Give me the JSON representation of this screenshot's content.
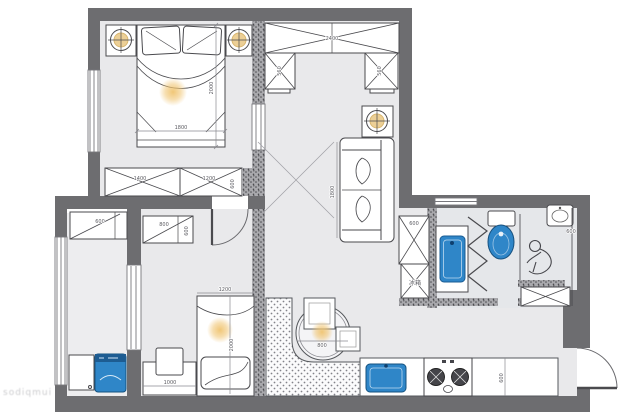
{
  "plan": {
    "wall_color": "#6d6d70",
    "floor_color": "#e9e9eb",
    "fixture_blue": "#2f86c8",
    "light_color": "#f0c470"
  },
  "labels": {
    "master_bed_width": "1800",
    "master_bed_length": "2000",
    "wardrobe_left": "1400",
    "wardrobe_right": "1200",
    "wardrobe_depth": "600",
    "hall_closet_width": "2400",
    "hall_closet_left_box": "560",
    "hall_closet_right_box": "560",
    "sofa_length": "1800",
    "fridge_width": "600",
    "fridge_label": "冰箱",
    "shower_width": "600",
    "bed2_width": "1200",
    "bed2_length": "2000",
    "desk_width": "1000",
    "dining_table_diameter": "800",
    "kitchen_counter_depth": "600",
    "balcony_cabinet_width": "600",
    "bed2_closet_width": "800",
    "bed2_closet_depth": "600",
    "watermark": "sodiqmui"
  }
}
